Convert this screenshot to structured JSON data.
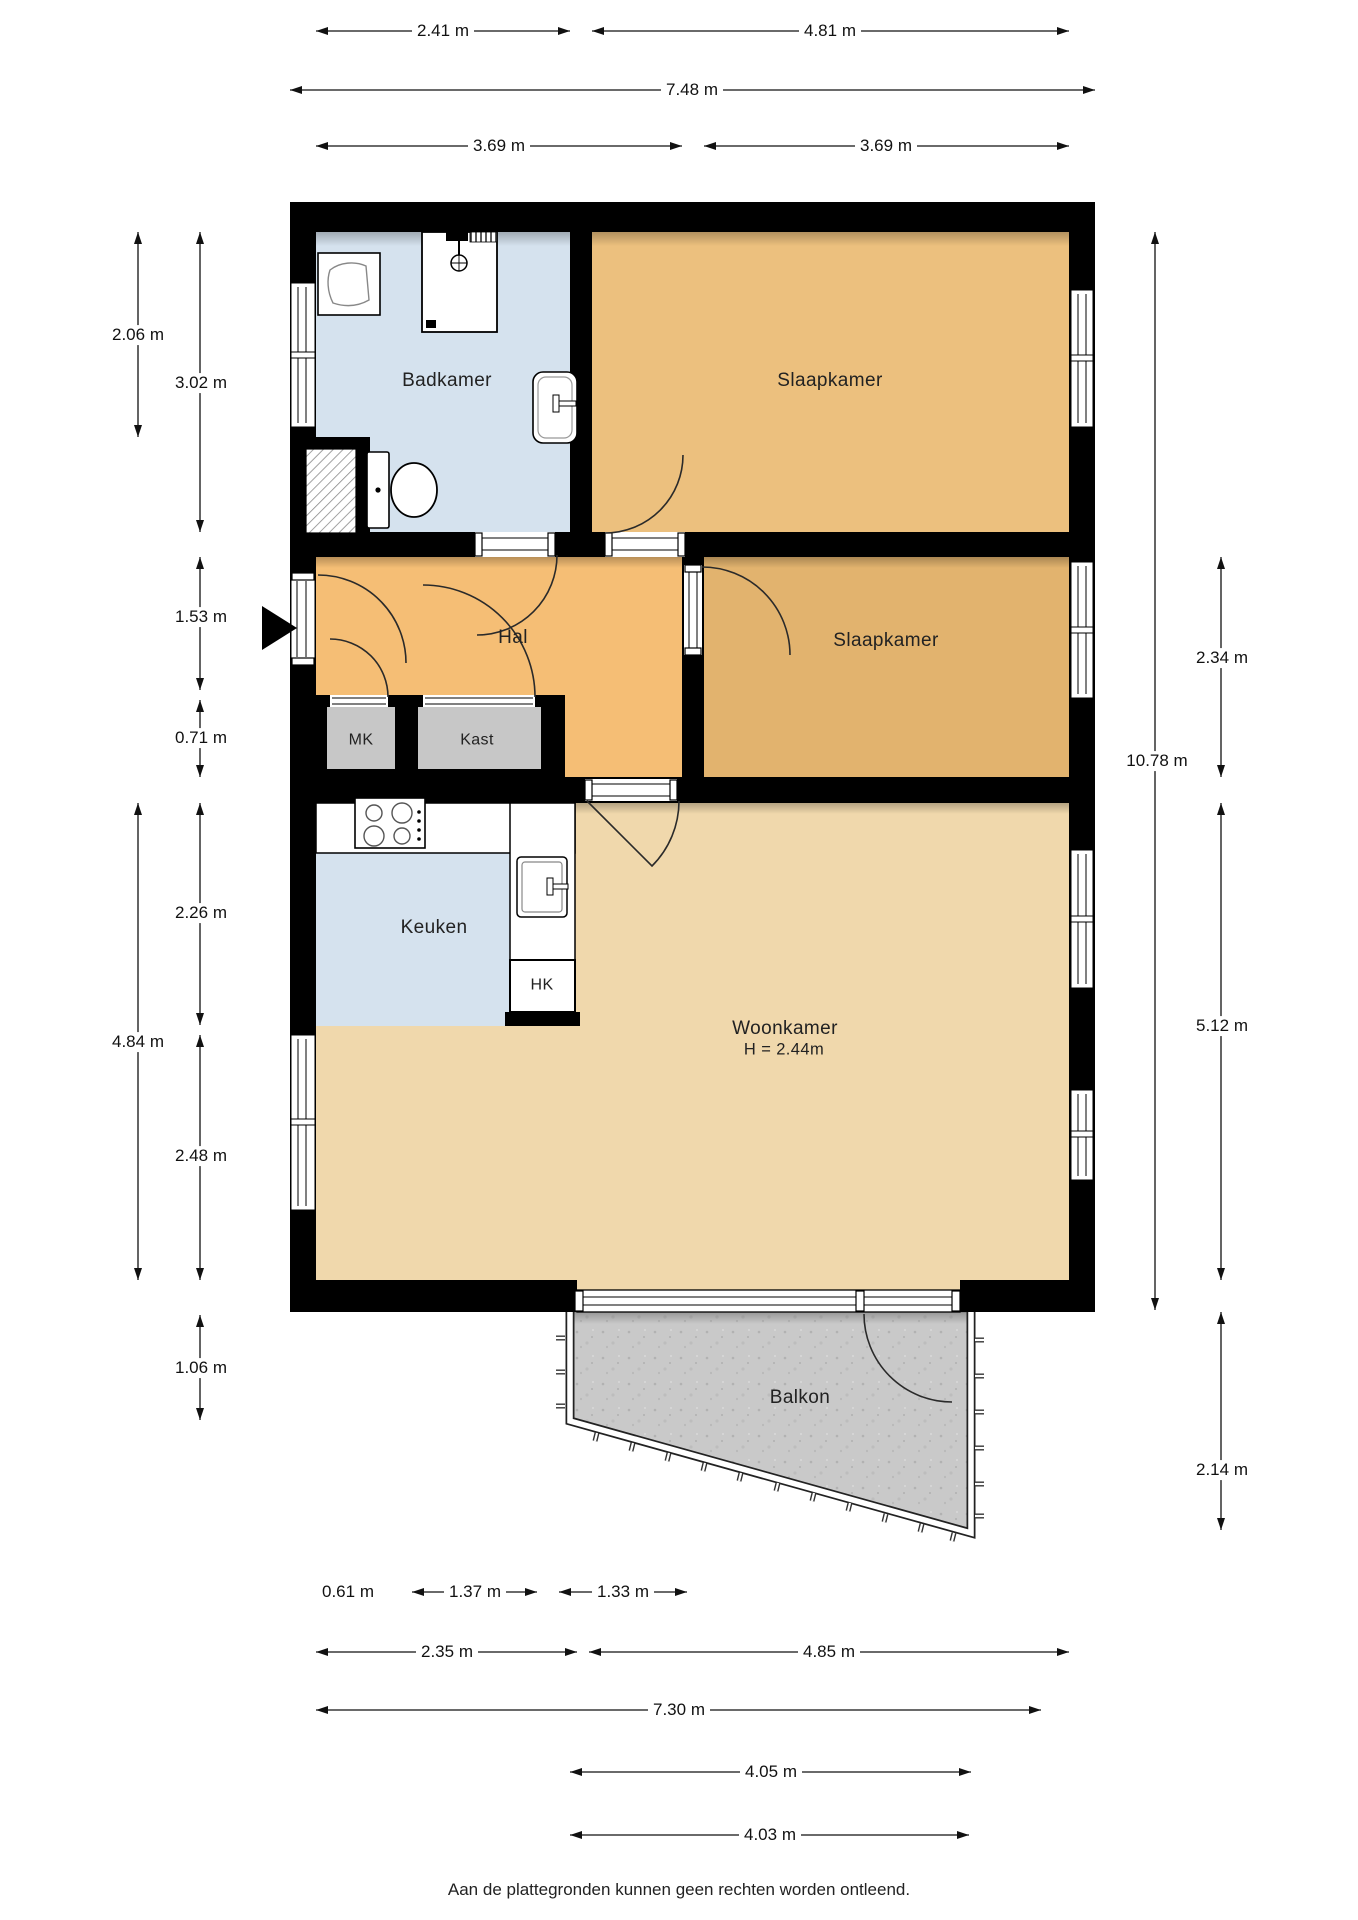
{
  "rooms": {
    "badkamer": "Badkamer",
    "slaapkamer_1": "Slaapkamer",
    "slaapkamer_2": "Slaapkamer",
    "hal": "Hal",
    "mk": "MK",
    "kast": "Kast",
    "keuken": "Keuken",
    "hk": "HK",
    "woonkamer": "Woonkamer",
    "woonkamer_ceiling_height": "H = 2.44m",
    "balkon": "Balkon"
  },
  "dimensions": {
    "top_row1_left": "2.41 m",
    "top_row1_right": "4.81 m",
    "top_row2_total": "7.48 m",
    "top_row3_left": "3.69 m",
    "top_row3_right": "3.69 m",
    "left_badkamer_window": "2.06 m",
    "left_badkamer": "3.02 m",
    "left_hal": "1.53 m",
    "left_mk": "0.71 m",
    "left_keuken": "2.26 m",
    "left_lower_total": "4.84 m",
    "left_woonkamer": "2.48 m",
    "left_balkon": "1.06 m",
    "right_total": "10.78 m",
    "right_slaapkamer2": "2.34 m",
    "right_woonkamer": "5.12 m",
    "right_balkon": "2.14 m",
    "bottom_row1_a": "0.61 m",
    "bottom_row1_b": "1.37 m",
    "bottom_row1_c": "1.33 m",
    "bottom_row2_left": "2.35 m",
    "bottom_row2_right": "4.85 m",
    "bottom_row3_total": "7.30 m",
    "bottom_row4_balkon_top": "4.05 m",
    "bottom_row5_balkon_bottom": "4.03 m"
  },
  "footer": {
    "disclaimer": "Aan de plattegronden kunnen geen rechten worden ontleend."
  },
  "colors": {
    "wall": "#000000",
    "hal_floor": "#F5BE75",
    "slaapkamer1_floor": "#ECC07E",
    "slaapkamer2_floor": "#E2B36E",
    "woonkamer_floor": "#F0D8AC",
    "badkamer_floor": "#D5E2EE",
    "keuken_floor": "#D5E2EE",
    "closet_floor": "#C7C7C7",
    "balkon_floor": "#C9C9C9"
  }
}
